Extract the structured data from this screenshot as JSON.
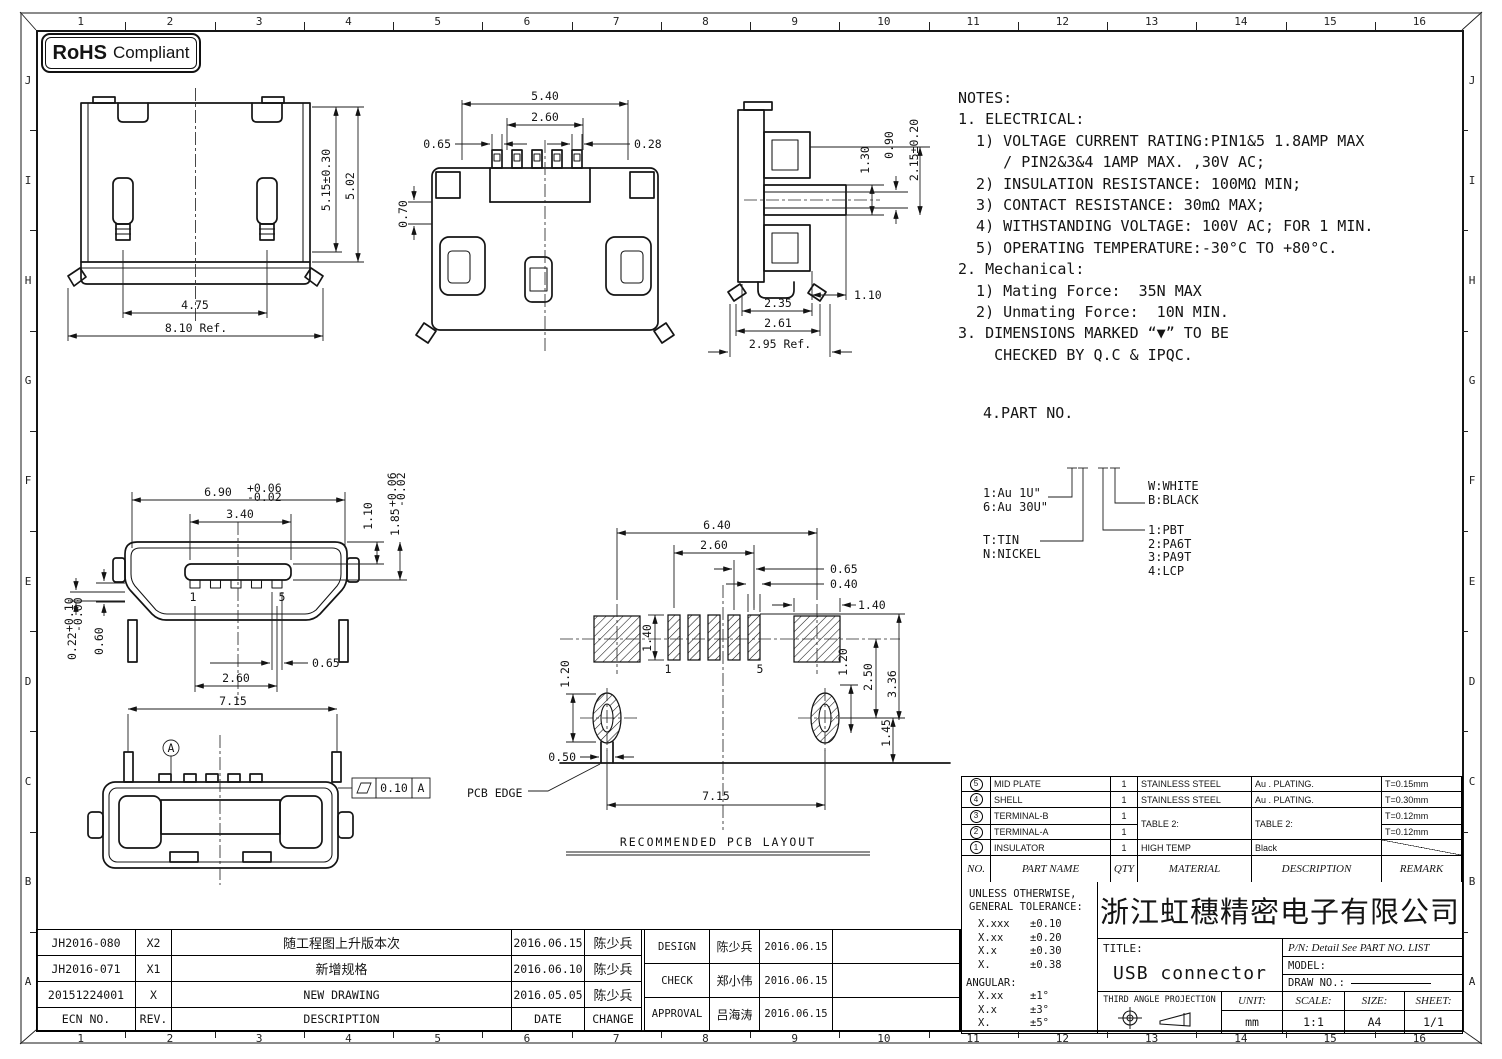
{
  "rohs": {
    "bold": "RoHS",
    "rest": "Compliant"
  },
  "border": {
    "cols": [
      "1",
      "2",
      "3",
      "4",
      "5",
      "6",
      "7",
      "8",
      "9",
      "10",
      "11",
      "12",
      "13",
      "14",
      "15",
      "16"
    ],
    "rows": [
      "J",
      "I",
      "H",
      "G",
      "F",
      "E",
      "D",
      "C",
      "B",
      "A"
    ]
  },
  "notes": {
    "lines": [
      "NOTES:",
      "1. ELECTRICAL:",
      "  1) VOLTAGE CURRENT RATING:PIN1&5 1.8AMP MAX",
      "     / PIN2&3&4 1AMP MAX. ,30V AC;",
      "  2) INSULATION RESISTANCE: 100MΩ MIN;",
      "  3) CONTACT RESISTANCE: 30mΩ MAX;",
      "  4) WITHSTANDING VOLTAGE: 100V AC; FOR 1 MIN.",
      "  5) OPERATING TEMPERATURE:-30°C TO +80°C.",
      "2. Mechanical:",
      "  1) Mating Force:  35N MAX",
      "  2) Unmating Force:  10N MIN.",
      "3. DIMENSIONS MARKED “▼” TO BE",
      "    CHECKED BY Q.C & IPQC."
    ]
  },
  "part_no": {
    "title": "4.PART NO.",
    "left_top": [
      "1:Au 1U\"",
      "6:Au 30U\""
    ],
    "left_bottom": [
      "T:TIN",
      "N:NICKEL"
    ],
    "right_top": [
      "W:WHITE",
      "B:BLACK"
    ],
    "right_bottom": [
      "1:PBT",
      "2:PA6T",
      "3:PA9T",
      "4:LCP"
    ]
  },
  "dims": {
    "v1": {
      "h1": "5.15±0.30",
      "h2": "5.02",
      "w1": "4.75",
      "w2": "8.10 Ref."
    },
    "v2": {
      "w1": "5.40",
      "w2": "2.60",
      "left": "0.65",
      "right": "0.28",
      "side": "0.70"
    },
    "v3": {
      "a": "1.30",
      "b": "0.90",
      "c": "2.15±0.20",
      "d": "1.10",
      "e": "2.35",
      "f": "2.61",
      "g": "2.95 Ref."
    },
    "v4": {
      "w1": "6.90",
      "w1t": "+0.06",
      "w1b": "-0.02",
      "w2": "3.40",
      "h1": "1.10",
      "h2": "1.85",
      "h2t": "+0.06",
      "h2b": "-0.02",
      "t1": "0.22",
      "t1t": "+0.10",
      "t1b": "-0.00",
      "h3": "0.60",
      "p1": "0.65",
      "p2": "2.60",
      "pin1": "1",
      "pin5": "5"
    },
    "v5": {
      "w1": "7.15",
      "datum": "A",
      "fcf": "0.10",
      "fcfd": "A"
    },
    "pcb": {
      "w1": "6.40",
      "w2": "2.60",
      "p1": "0.65",
      "p2": "0.40",
      "p3": "1.40",
      "p4": "1.40",
      "lh": "1.20",
      "rh": "1.20",
      "r2": "2.50",
      "r3": "3.36",
      "r4": "1.45",
      "stem": "0.50",
      "span": "7.15",
      "pin1": "1",
      "pin5": "5",
      "edge": "PCB EDGE",
      "title": "RECOMMENDED PCB LAYOUT"
    }
  },
  "bom": {
    "headers": {
      "no": "NO.",
      "part": "PART NAME",
      "qty": "QTY",
      "material": "MATERIAL",
      "desc": "DESCRIPTION",
      "remark": "REMARK"
    },
    "rows": [
      {
        "no": "5",
        "part": "MID PLATE",
        "qty": "1",
        "material": "STAINLESS STEEL",
        "desc": "Au . PLATING.",
        "remark": "T=0.15mm"
      },
      {
        "no": "4",
        "part": "SHELL",
        "qty": "1",
        "material": "STAINLESS STEEL",
        "desc": "Au . PLATING.",
        "remark": "T=0.30mm"
      },
      {
        "no": "3",
        "part": "TERMINAL-B",
        "qty": "1",
        "material": "TABLE 2:",
        "desc": "TABLE 2:",
        "remark": "T=0.12mm"
      },
      {
        "no": "2",
        "part": "TERMINAL-A",
        "qty": "1",
        "material": "",
        "desc": "",
        "remark": "T=0.12mm"
      },
      {
        "no": "1",
        "part": "INSULATOR",
        "qty": "1",
        "material": "HIGH TEMP",
        "desc": "Black",
        "remark": ""
      }
    ]
  },
  "tolerance": {
    "l1": "UNLESS OTHERWISE,",
    "l2": "GENERAL TOLERANCE:",
    "rows": [
      [
        "X.xxx",
        "±0.10"
      ],
      [
        "X.xx",
        "±0.20"
      ],
      [
        "X.x",
        "±0.30"
      ],
      [
        "X.",
        "±0.38"
      ]
    ],
    "angular": "ANGULAR:",
    "arows": [
      [
        "X.xx",
        "±1°"
      ],
      [
        "X.x",
        "±3°"
      ],
      [
        "X.",
        "±5°"
      ]
    ]
  },
  "company": "浙江虹穗精密电子有限公司",
  "title_block": {
    "title_label": "TITLE:",
    "title": "USB connector",
    "pn": "P/N: Detail See PART NO. LIST",
    "model_label": "MODEL:",
    "draw_label": "DRAW NO.:",
    "projection": "THIRD ANGLE PROJECTION",
    "unit_label": "UNIT:",
    "unit": "mm",
    "scale_label": "SCALE:",
    "scale": "1:1",
    "size_label": "SIZE:",
    "size": "A4",
    "sheet_label": "SHEET:",
    "sheet": "1/1"
  },
  "revisions": {
    "headers": {
      "ecn": "ECN NO.",
      "rev": "REV.",
      "desc": "DESCRIPTION",
      "date": "DATE",
      "change": "CHANGE"
    },
    "rows": [
      {
        "ecn": "JH2016-080",
        "rev": "X2",
        "desc": "随工程图上升版本次",
        "date": "2016.06.15",
        "change": "陈少兵"
      },
      {
        "ecn": "JH2016-071",
        "rev": "X1",
        "desc": "新增规格",
        "date": "2016.06.10",
        "change": "陈少兵"
      },
      {
        "ecn": "20151224001",
        "rev": "X",
        "desc": "NEW DRAWING",
        "date": "2016.05.05",
        "change": "陈少兵"
      }
    ]
  },
  "approvals": {
    "rows": [
      {
        "role": "DESIGN",
        "name": "陈少兵",
        "date": "2016.06.15"
      },
      {
        "role": "CHECK",
        "name": "郑小伟",
        "date": "2016.06.15"
      },
      {
        "role": "APPROVAL",
        "name": "吕海涛",
        "date": "2016.06.15"
      }
    ]
  }
}
